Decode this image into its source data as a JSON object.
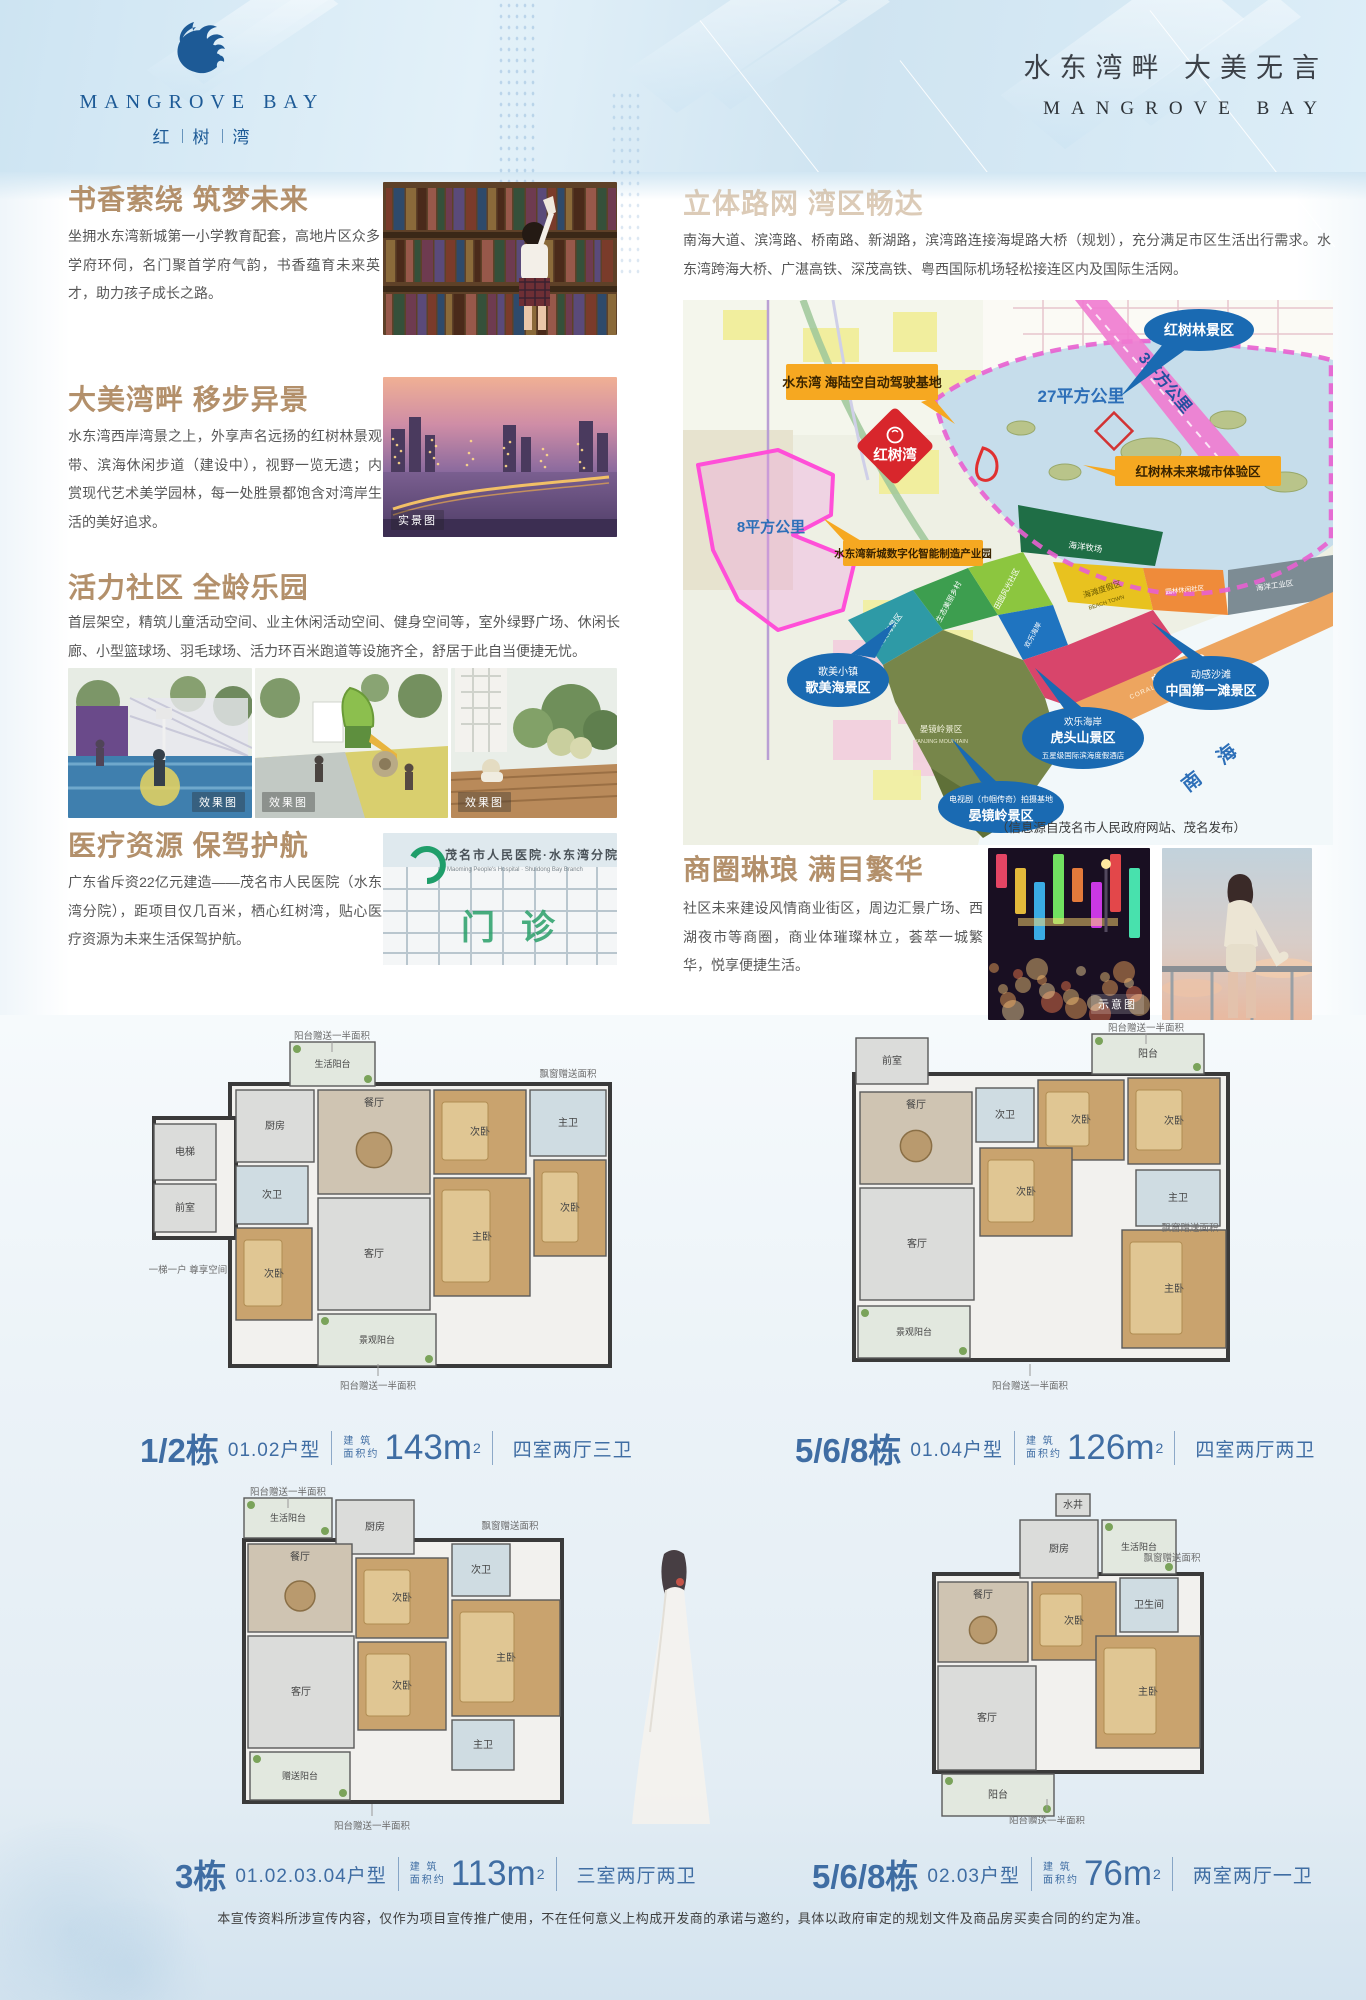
{
  "brand": {
    "name_en": "MANGROVE BAY",
    "name_cn_chars": [
      "红",
      "树",
      "湾"
    ],
    "slogan_cn": "水东湾畔  大美无言",
    "slogan_en": "MANGROVE BAY"
  },
  "sections": {
    "education": {
      "title": "书香萦绕 筑梦未来",
      "body": "坐拥水东湾新城第一小学教育配套，高地片区众多学府环伺，名门聚首学府气韵，书香蕴育未来英才，助力孩子成长之路。"
    },
    "scenery": {
      "title": "大美湾畔 移步异景",
      "body": "水东湾西岸湾景之上，外享声名远扬的红树林景观带、滨海休闲步道（建设中），视野一览无遗；内赏现代艺术美学园林，每一处胜景都饱含对湾岸生活的美好追求。",
      "photo_tag": "实景图"
    },
    "community": {
      "title": "活力社区 全龄乐园",
      "body": "首层架空，精筑儿童活动空间、业主休闲活动空间、健身空间等，室外绿野广场、休闲长廊、小型篮球场、羽毛球场、活力环百米跑道等设施齐全，舒居于此自当便捷无忧。",
      "photo_tags": [
        "效果图",
        "效果图",
        "效果图"
      ]
    },
    "medical": {
      "title": "医疗资源 保驾护航",
      "body": "广东省斥资22亿元建造——茂名市人民医院（水东湾分院），距项目仅几百米，栖心红树湾，贴心医疗资源为未来生活保驾护航。",
      "photo_sign_cn": "茂名市人民医院·水东湾分院",
      "photo_sign_en": "Maoming People's Hospital · Shuidong Bay Branch",
      "photo_sign_big": "门诊"
    },
    "traffic": {
      "title": "立体路网 湾区畅达",
      "body": "南海大道、滨湾路、桥南路、新湖路，滨湾路连接海堤路大桥（规划），充分满足市区生活出行需求。水东湾跨海大桥、广湛高铁、深茂高铁、粤西国际机场轻松接连区内及国际生活网。"
    },
    "business": {
      "title": "商圈琳琅 满目繁华",
      "body": "社区未来建设风情商业街区，周边汇景广场、西湖夜市等商圈，商业体璀璨林立，荟萃一城繁华，悦享便捷生活。",
      "photo_tag": "示意图"
    }
  },
  "map": {
    "label_auto_driving": "水东湾 海陆空自动驾驶基地",
    "label_project": "红树湾",
    "label_mangrove_scenic": "红树林景区",
    "area_27": "27平方公里",
    "area_8": "8平方公里",
    "area_3": "3平方公里",
    "label_industry_park": "水东湾新城数字化智能制造产业园",
    "label_future_city": "红树林未来城市体验区",
    "ellipse_gemei": [
      "歌美小镇",
      "歌美海景区"
    ],
    "ellipse_beach": [
      "动感沙滩",
      "中国第一滩景区"
    ],
    "ellipse_hutou": [
      "欢乐海岸",
      "虎头山景区",
      "五星级国际滨海度假酒店"
    ],
    "ellipse_yanjing": [
      "电视剧（巾帼传奇）拍摄基地",
      "晏镜岭景区"
    ],
    "zone_yanjing": "晏镜岭景区",
    "zone_yanjing_en": "YANJING MOUNTAIN",
    "sea": "南  海",
    "credit": "（信息源自茂名市人民政府网站、茂名发布）",
    "zones": [
      {
        "text": "歌美海景区",
        "en": "FISHERMEN'S VILLAGE"
      },
      {
        "text": "生态美丽乡村",
        "en": "FARMER'S VILLAGE"
      },
      {
        "text": "田园风光社区",
        "en": "RICE FIELD COMMUNITY"
      },
      {
        "text": "欢乐海岸",
        "en": "OCT BAY"
      },
      {
        "text": "海滩度假区",
        "en": "BEACH TOWN"
      },
      {
        "text": "中国第一滩",
        "en": "CORAL BEACH"
      },
      {
        "text": "园林休闲社区",
        "en": "ISLAND COMMUNITY"
      },
      {
        "text": "海洋工业区",
        "en": "PORT INDUSTRY"
      },
      {
        "text": "海洋牧场",
        "en": "OCEAN RANCH"
      }
    ]
  },
  "floorplans": [
    {
      "building": "1/2栋",
      "unit": "01.02户型",
      "area_cap1": "建 筑",
      "area_cap2": "面积约",
      "area_num": "143",
      "area_unit": "m",
      "area_sup": "2",
      "layout": "四室两厅三卫",
      "rooms": [
        "生活阳台",
        "厨房",
        "餐厅",
        "次卧",
        "主卫",
        "次卫",
        "客厅",
        "主卧",
        "次卧",
        "次卧",
        "景观阳台",
        "电梯",
        "前室"
      ],
      "callouts": [
        "阳台赠送一半面积",
        "飘窗赠送面积",
        "一梯一户 尊享空间",
        "阳台赠送一半面积"
      ]
    },
    {
      "building": "5/6/8栋",
      "unit": "01.04户型",
      "area_cap1": "建 筑",
      "area_cap2": "面积约",
      "area_num": "126",
      "area_unit": "m",
      "area_sup": "2",
      "layout": "四室两厅两卫",
      "rooms": [
        "前室",
        "阳台",
        "餐厅",
        "次卫",
        "次卧",
        "次卧",
        "次卧",
        "客厅",
        "主卫",
        "主卧",
        "景观阳台"
      ],
      "callouts": [
        "阳台赠送一半面积",
        "飘窗赠送面积",
        "阳台赠送一半面积"
      ]
    },
    {
      "building": "3栋",
      "unit": "01.02.03.04户型",
      "area_cap1": "建 筑",
      "area_cap2": "面积约",
      "area_num": "113",
      "area_unit": "m",
      "area_sup": "2",
      "layout": "三室两厅两卫",
      "rooms": [
        "生活阳台",
        "厨房",
        "餐厅",
        "次卧",
        "次卫",
        "主卧",
        "客厅",
        "次卧",
        "主卫",
        "赠送阳台"
      ],
      "callouts": [
        "阳台赠送一半面积",
        "飘窗赠送面积",
        "阳台赠送一半面积"
      ]
    },
    {
      "building": "5/6/8栋",
      "unit": "02.03户型",
      "area_cap1": "建 筑",
      "area_cap2": "面积约",
      "area_num": "76",
      "area_unit": "m",
      "area_sup": "2",
      "layout": "两室两厅一卫",
      "rooms": [
        "水井",
        "厨房",
        "生活阳台",
        "餐厅",
        "次卧",
        "卫生间",
        "主卧",
        "客厅",
        "阳台"
      ],
      "callouts": [
        "飘窗赠送面积",
        "阳台赠送一半面积"
      ]
    }
  ],
  "footer": "本宣传资料所涉宣传内容，仅作为项目宣传推广使用，不在任何意义上构成开发商的承诺与邀约，具体以政府审定的规划文件及商品房买卖合同的约定为准。"
}
